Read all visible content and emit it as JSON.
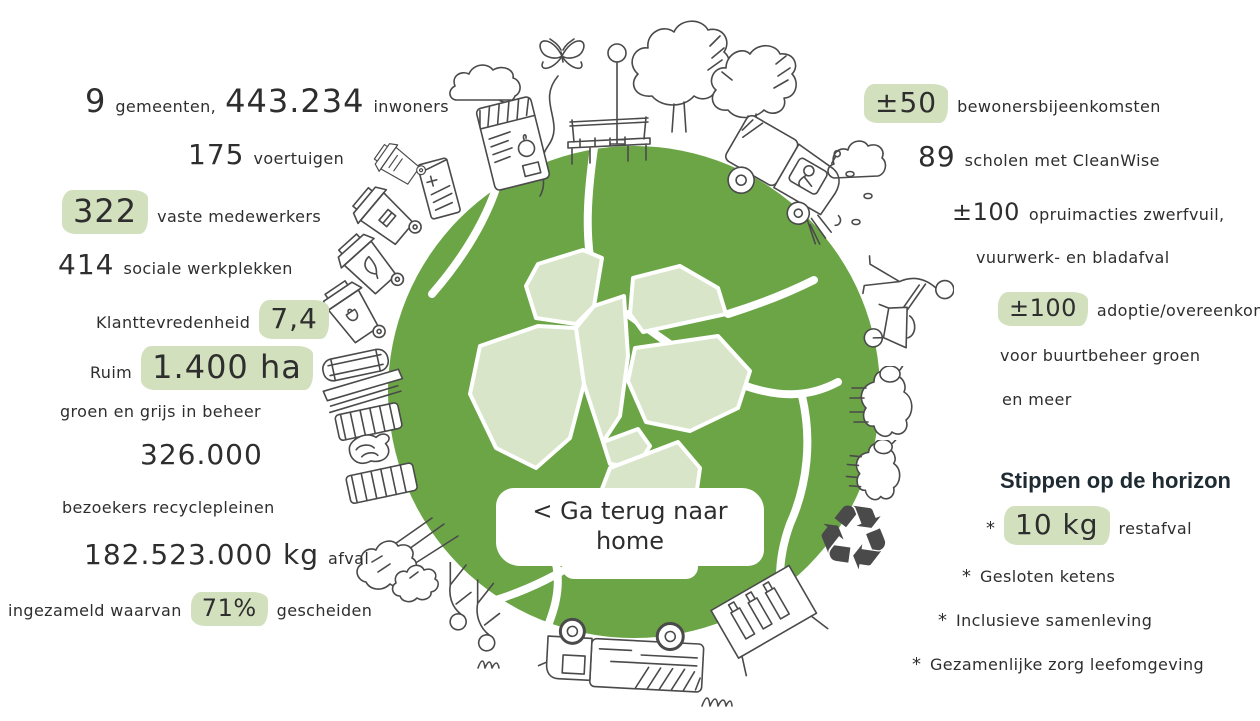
{
  "colors": {
    "globe_green": "#6BA546",
    "map_green": "#D8E5C9",
    "highlight": "#D3E0BE",
    "ink": "#2E2E2E",
    "heading_dark": "#1E2B33",
    "doodle": "#4A4A4A"
  },
  "center": {
    "back_button": "< Ga terug naar home"
  },
  "left": {
    "l1n1": "9",
    "l1t1": "gemeenten,",
    "l1n2": "443.234",
    "l1t2": "inwoners",
    "l2n1": "175",
    "l2t1": "voertuigen",
    "l3n1": "322",
    "l3t1": "vaste medewerkers",
    "l4n1": "414",
    "l4t1": "sociale werkplekken",
    "l5t1": "Klanttevredenheid",
    "l5n1": "7,4",
    "l6t1": "Ruim",
    "l6n1": "1.400 ha",
    "l7t1": "groen en grijs in beheer",
    "l8n1": "326.000",
    "l9t1": "bezoekers recyclepleinen",
    "l10n1": "182.523.000 kg",
    "l10t1": "afval",
    "l11t1": "ingezameld waarvan",
    "l11n1": "71%",
    "l11t2": "gescheiden"
  },
  "right": {
    "r1n1": "±50",
    "r1t1": "bewonersbijeenkomsten",
    "r2n1": "89",
    "r2t1": "scholen met CleanWise",
    "r3n1": "±100",
    "r3t1": "opruimacties zwerfvuil,",
    "r4t1": "vuurwerk- en bladafval",
    "r5n1": "±100",
    "r5t1": "adoptie/overeenkomsten",
    "r6t1": "voor buurtbeheer groen",
    "r7t1": "en meer",
    "heading": "Stippen op de horizon",
    "bullet_marker": "*",
    "b1n1": "10 kg",
    "b1t1": "restafval",
    "b2t1": "Gesloten ketens",
    "b3t1": "Inclusieve samenleving",
    "b4t1": "Gezamenlijke zorg leefomgeving"
  },
  "icons": {
    "recycle_glyph": "♻",
    "doodle_names": [
      "cloud",
      "butterfly",
      "compost-bag",
      "drink-carton",
      "park-bench",
      "street-lamp",
      "tree",
      "tree",
      "street-sweeper",
      "cloud",
      "leaf-specks",
      "wheelbarrow-person",
      "sheep",
      "sheep",
      "recycle-symbol",
      "glass-container-rack",
      "garbage-truck",
      "litter-pickers",
      "bushes-with-rakes",
      "wheelie-bin",
      "wheelie-bin",
      "wheelie-bin",
      "wheelie-bin",
      "bulky-waste-pile",
      "grass-tuft"
    ]
  }
}
